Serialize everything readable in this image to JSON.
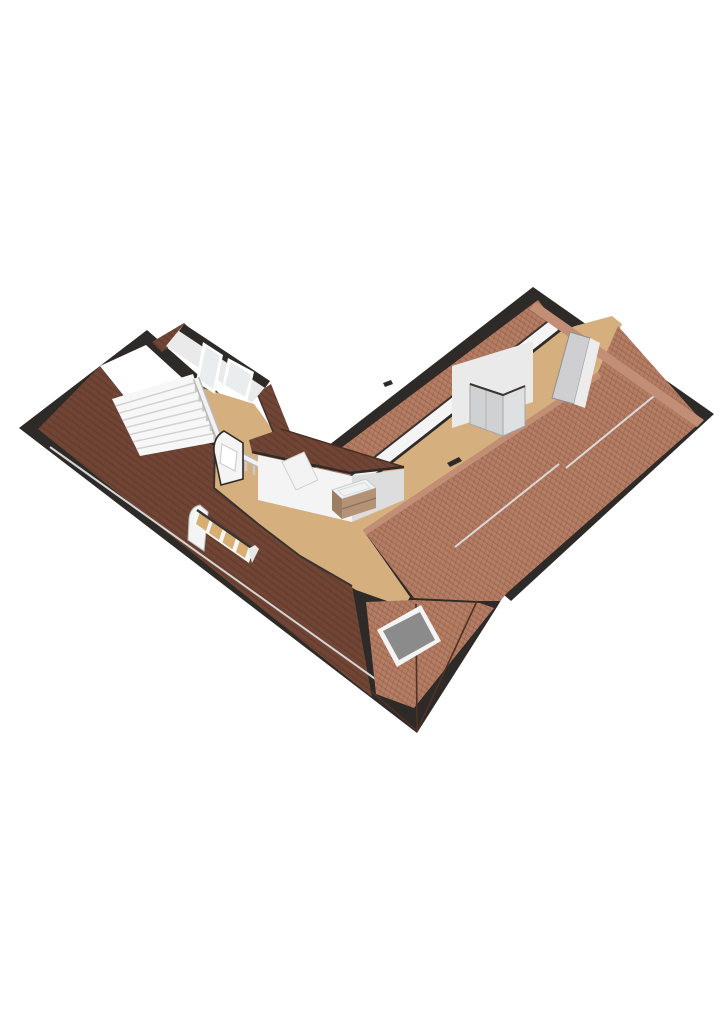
{
  "scene": {
    "kind": "isometric-3d-floorplan",
    "view": "attic-floor-birdseye",
    "background": "#ffffff",
    "palette": {
      "outline": "#2e2a27",
      "roof_dark": "#6f4434",
      "roof_dark_line": "#583326",
      "roof_brick": "#b27a61",
      "roof_brick_line": "#82543e",
      "ridge_salmon": "#c28e76",
      "floor": "#d5b07e",
      "wall_bright": "#f4f4f4",
      "wall_mid": "#eaeaea",
      "wall_dark": "#cfcfd2",
      "glass": "#e9edee",
      "dormer_glass": "#d9ae72",
      "skylight_glass": "#8b8b8b",
      "skylight_frame": "#f4f4f4",
      "stair_white": "#f7f7f7",
      "stair_line": "#d2d2d2",
      "rail_white": "#f2f2f2",
      "rail_shadow": "#c9c9c9",
      "closet_door_a": "#d0d1d3",
      "closet_door_b": "#dfe0e2",
      "vanity_basin": "#f0f2f1",
      "vanity_wood": "#b39277",
      "vanity_wood_dark": "#9c7e62",
      "gutter": "#d6d6d6",
      "seam": "#dadada"
    },
    "elements": [
      "left-wing-roof",
      "right-wing-roof",
      "hip-roof-corner",
      "roof-skylight",
      "stairwell-opening",
      "staircase",
      "stair-balustrade",
      "rear-wall",
      "rear-wall-door-window",
      "rear-wall-window",
      "roof-dormer-window-band",
      "small-dormer",
      "center-bay-hip-roof",
      "vanity-unit",
      "wardrobe-closet",
      "knee-wall",
      "gable-wedge",
      "roof-seam-lines",
      "gutter-line",
      "floor-area"
    ]
  }
}
